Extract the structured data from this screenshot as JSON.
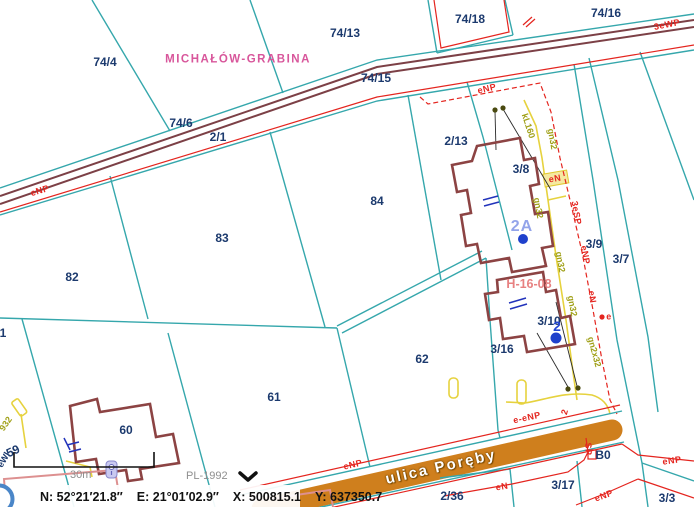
{
  "map": {
    "labels": [
      {
        "t": "74/4",
        "x": 105,
        "y": 62,
        "c": "parcel"
      },
      {
        "t": "74/13",
        "x": 345,
        "y": 33,
        "c": "parcel"
      },
      {
        "t": "74/18",
        "x": 470,
        "y": 19,
        "c": "parcel"
      },
      {
        "t": "74/16",
        "x": 606,
        "y": 13,
        "c": "parcel"
      },
      {
        "t": "74/15",
        "x": 376,
        "y": 78,
        "c": "parcel"
      },
      {
        "t": "74/6",
        "x": 181,
        "y": 123,
        "c": "parcel"
      },
      {
        "t": "2/1",
        "x": 218,
        "y": 137,
        "c": "parcel"
      },
      {
        "t": "2/13",
        "x": 456,
        "y": 141,
        "c": "parcel"
      },
      {
        "t": "3/8",
        "x": 521,
        "y": 169,
        "c": "parcel"
      },
      {
        "t": "3/9",
        "x": 594,
        "y": 244,
        "c": "parcel"
      },
      {
        "t": "3/7",
        "x": 621,
        "y": 259,
        "c": "parcel"
      },
      {
        "t": "3/10",
        "x": 549,
        "y": 321,
        "c": "parcel"
      },
      {
        "t": "3/16",
        "x": 502,
        "y": 349,
        "c": "parcel"
      },
      {
        "t": "82",
        "x": 72,
        "y": 277,
        "c": "parcel"
      },
      {
        "t": "83",
        "x": 222,
        "y": 238,
        "c": "parcel"
      },
      {
        "t": "84",
        "x": 377,
        "y": 201,
        "c": "parcel"
      },
      {
        "t": "62",
        "x": 422,
        "y": 359,
        "c": "parcel"
      },
      {
        "t": "61",
        "x": 274,
        "y": 397,
        "c": "parcel"
      },
      {
        "t": "60",
        "x": 126,
        "y": 430,
        "c": "parcel"
      },
      {
        "t": "2/36",
        "x": 452,
        "y": 496,
        "c": "parcel"
      },
      {
        "t": "3/17",
        "x": 563,
        "y": 485,
        "c": "parcel"
      },
      {
        "t": "3/3",
        "x": 667,
        "y": 498,
        "c": "parcel"
      },
      {
        "t": "B0",
        "x": 603,
        "y": 455,
        "c": "parcel"
      },
      {
        "t": "59",
        "x": 13,
        "y": 451,
        "rot": -25,
        "c": "parcel"
      },
      {
        "t": "1",
        "x": 3,
        "y": 333,
        "c": "parcel"
      },
      {
        "t": "MICHAŁÓW-GRABINA",
        "x": 238,
        "y": 60,
        "c": "place"
      },
      {
        "t": "2A",
        "x": 522,
        "y": 227,
        "c": "c2a"
      },
      {
        "t": "2",
        "x": 557,
        "y": 326,
        "c": "cblue2"
      },
      {
        "t": "H-16-08",
        "x": 529,
        "y": 284,
        "c": "pink"
      },
      {
        "t": "ulica Poręby",
        "x": 441,
        "y": 467,
        "rot": -12.8,
        "c": "street"
      },
      {
        "t": "eNP",
        "x": 40,
        "y": 191,
        "rot": -17,
        "c": "red"
      },
      {
        "t": "eNP",
        "x": 487,
        "y": 89,
        "rot": -13,
        "c": "red"
      },
      {
        "t": "eN",
        "x": 555,
        "y": 179,
        "rot": -10,
        "c": "red"
      },
      {
        "t": "3eSP",
        "x": 576,
        "y": 213,
        "rot": 80,
        "c": "red"
      },
      {
        "t": "eNP",
        "x": 585,
        "y": 255,
        "rot": 80,
        "c": "red"
      },
      {
        "t": "eN",
        "x": 592,
        "y": 297,
        "rot": 82,
        "c": "red"
      },
      {
        "t": "e",
        "x": 609,
        "y": 317,
        "c": "red"
      },
      {
        "t": "eNP",
        "x": 353,
        "y": 465,
        "rot": -13,
        "c": "red"
      },
      {
        "t": "e-eNP",
        "x": 527,
        "y": 418,
        "rot": -12,
        "c": "red"
      },
      {
        "t": "2",
        "x": 565,
        "y": 412,
        "rot": -75,
        "c": "red"
      },
      {
        "t": "SP",
        "x": 588,
        "y": 449,
        "rot": 88,
        "c": "red"
      },
      {
        "t": "eN",
        "x": 502,
        "y": 487,
        "rot": -10,
        "c": "red"
      },
      {
        "t": "eNP",
        "x": 604,
        "y": 496,
        "rot": -20,
        "c": "red"
      },
      {
        "t": "eNP",
        "x": 672,
        "y": 461,
        "rot": -8,
        "c": "red"
      },
      {
        "t": "3eWP",
        "x": 667,
        "y": 25,
        "rot": -11,
        "c": "red"
      },
      {
        "t": "kL160",
        "x": 528,
        "y": 126,
        "rot": 72,
        "c": "olive"
      },
      {
        "t": "gn32",
        "x": 552,
        "y": 139,
        "rot": 80,
        "c": "olive"
      },
      {
        "t": "gn32",
        "x": 538,
        "y": 208,
        "rot": 80,
        "c": "olive"
      },
      {
        "t": "gn32",
        "x": 560,
        "y": 262,
        "rot": 80,
        "c": "olive"
      },
      {
        "t": "gn32",
        "x": 572,
        "y": 306,
        "rot": 80,
        "c": "olive"
      },
      {
        "t": "gn2x32",
        "x": 594,
        "y": 352,
        "rot": 75,
        "c": "olive"
      },
      {
        "t": "932",
        "x": 6,
        "y": 424,
        "rot": -55,
        "c": "olive"
      },
      {
        "t": "eWl",
        "x": 4,
        "y": 460,
        "rot": -60,
        "c": "navysm"
      }
    ]
  },
  "statusbar": {
    "coord_n": "N: 52°21′21.8″",
    "coord_e": "E: 21°01′02.9″",
    "coord_x": "X: 500815.1",
    "coord_y": "Y: 637350.7",
    "scale_label": "30m",
    "crs_label": "PL-1992"
  },
  "colors": {
    "parcel_boundary_teal": "#35a7ac",
    "road_casing_maroon": "#7c4046",
    "utility_red": "#e4251f",
    "gas_olive": "#b0a020",
    "gas_yellow": "#e6d23e",
    "street_fill_orange": "#cf7f1d",
    "parcel_text_navy": "#1c3a6e",
    "place_magenta": "#d8569b",
    "hydro_pink": "#e78181",
    "building_outline": "#8c4343",
    "blue_symbol": "#1f41cc"
  }
}
